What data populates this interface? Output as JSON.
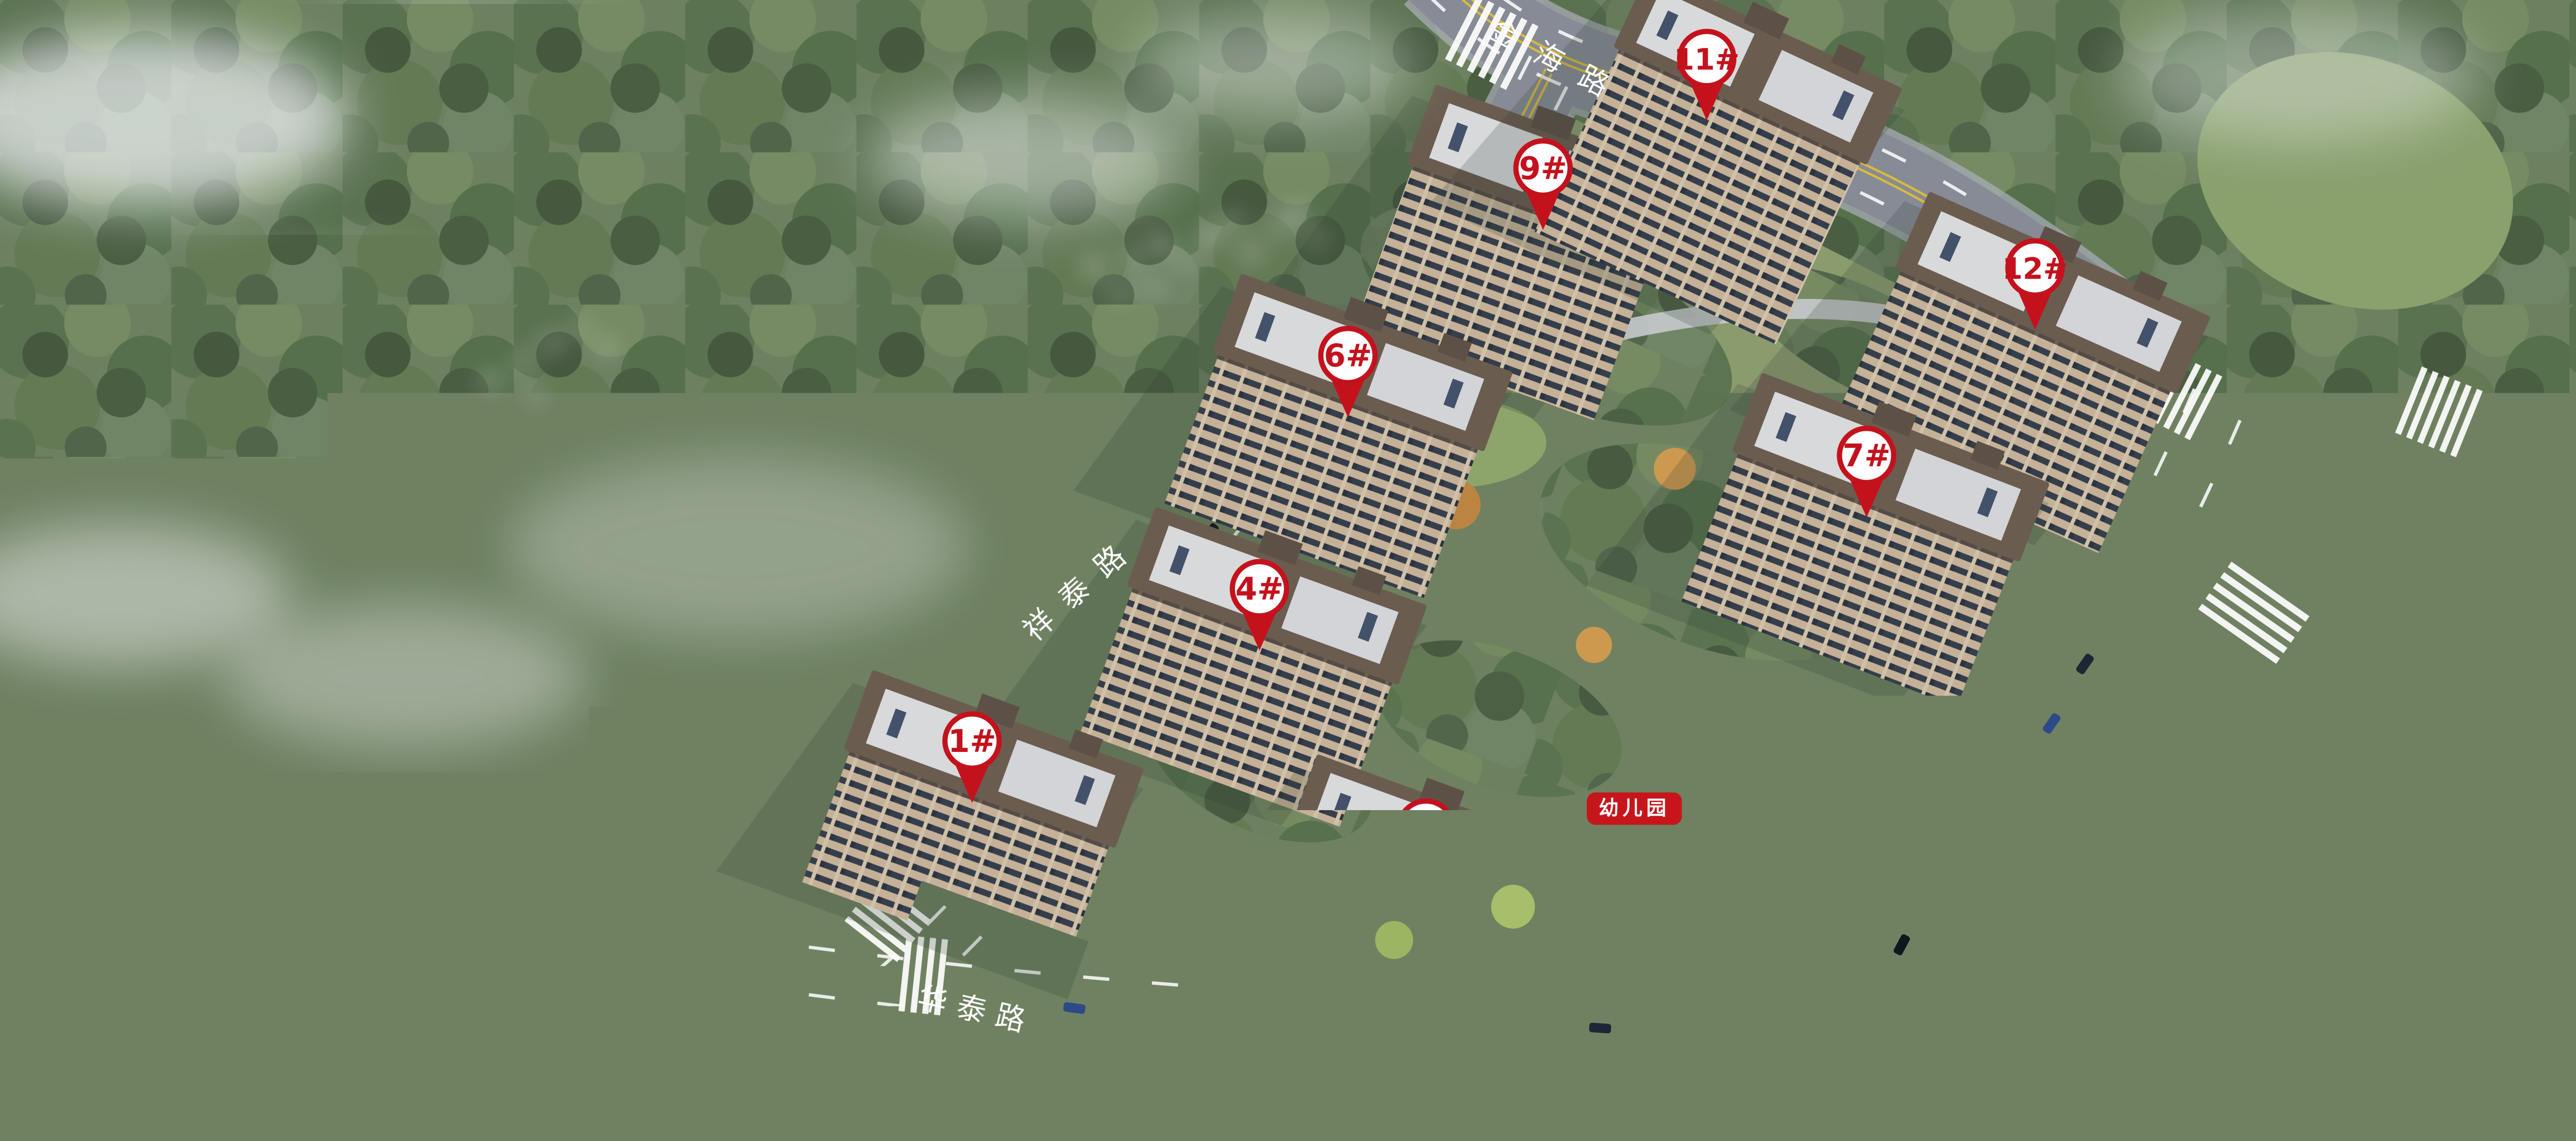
{
  "scene": {
    "caption": "鸟瞰图"
  },
  "roads": {
    "north": {
      "name": "金海路"
    },
    "west": {
      "name": "祥泰路"
    },
    "east": {
      "name": "安泰路"
    },
    "south": {
      "name": "华泰路"
    }
  },
  "markers": [
    {
      "id": "1",
      "label": "1#"
    },
    {
      "id": "2",
      "label": "2#"
    },
    {
      "id": "4",
      "label": "4#"
    },
    {
      "id": "6",
      "label": "6#"
    },
    {
      "id": "7",
      "label": "7#"
    },
    {
      "id": "9",
      "label": "9#"
    },
    {
      "id": "11",
      "label": "11#"
    },
    {
      "id": "12",
      "label": "12#"
    }
  ],
  "facilities": {
    "kindergarten": "幼儿园"
  },
  "colors": {
    "marker_red": "#c4121d",
    "label_red": "#c6161c",
    "road_label": "#ffffff",
    "caption": "#f2f3f4"
  }
}
